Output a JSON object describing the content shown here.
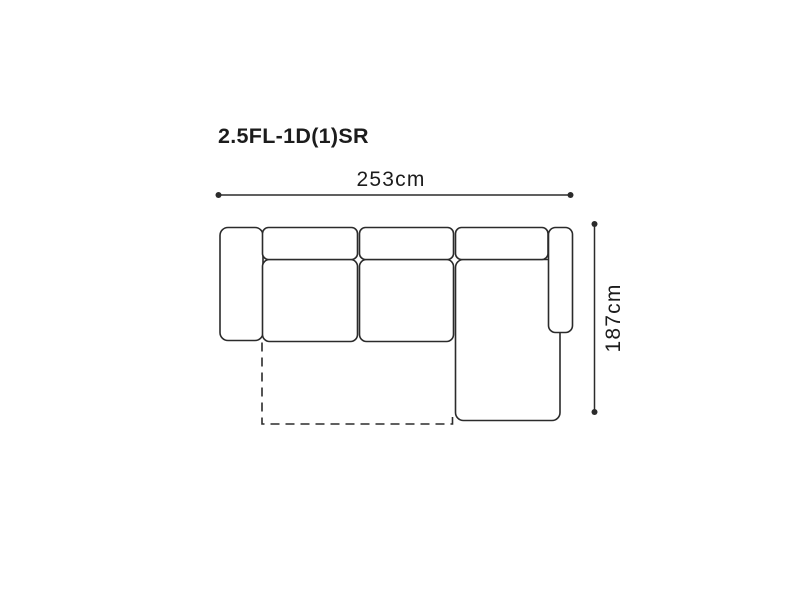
{
  "page": {
    "background": "#ffffff"
  },
  "diagram": {
    "title": "2.5FL-1D(1)SR",
    "dimensions": {
      "width": {
        "label": "253cm",
        "value_cm": 253,
        "orientation": "horizontal"
      },
      "depth": {
        "label": "187cm",
        "value_cm": 187,
        "orientation": "vertical"
      }
    },
    "colors": {
      "line": "#2b2b2b",
      "text": "#1c1c1c",
      "fill": "#ffffff"
    },
    "parts": [
      {
        "name": "left-armrest",
        "style": "solid"
      },
      {
        "name": "back-cushion-1",
        "style": "solid"
      },
      {
        "name": "back-cushion-2",
        "style": "solid"
      },
      {
        "name": "back-cushion-3",
        "style": "solid"
      },
      {
        "name": "seat-cushion-1",
        "style": "solid"
      },
      {
        "name": "seat-cushion-2",
        "style": "solid"
      },
      {
        "name": "chaise-lounge",
        "style": "solid"
      },
      {
        "name": "right-armrest",
        "style": "solid"
      },
      {
        "name": "pull-out-extension",
        "style": "dashed"
      }
    ]
  }
}
